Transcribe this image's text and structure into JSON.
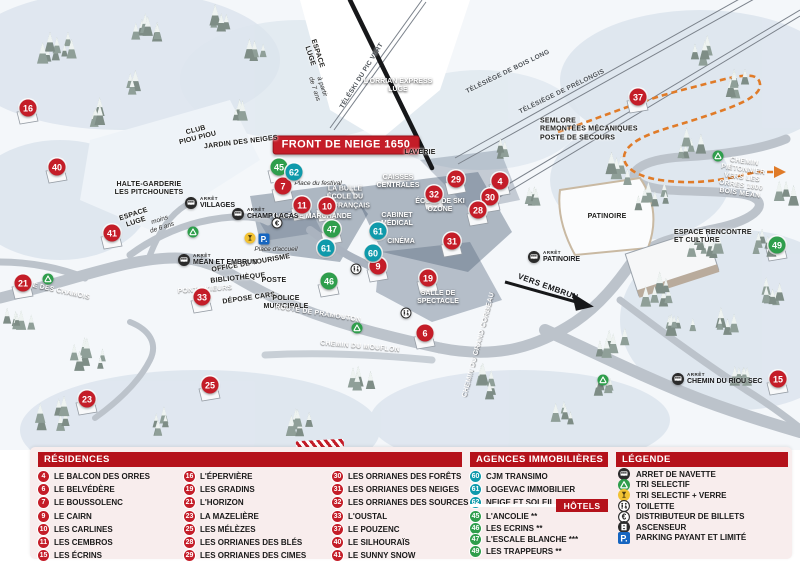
{
  "colors": {
    "residence": "#c41d28",
    "hotel": "#2f9e4c",
    "agency": "#0f9aab",
    "header_bar": "#b5121b",
    "panel_bg": "#f8eded",
    "path_orange": "#e07b28"
  },
  "map": {
    "banner": "FRONT DE NEIGE 1650",
    "bus_stop_prefix": "ARRÊT",
    "markers": [
      {
        "num": "16",
        "type": "residence",
        "x": 28,
        "y": 108
      },
      {
        "num": "40",
        "type": "residence",
        "x": 57,
        "y": 167
      },
      {
        "num": "41",
        "type": "residence",
        "x": 112,
        "y": 233
      },
      {
        "num": "21",
        "type": "residence",
        "x": 23,
        "y": 283
      },
      {
        "num": "23",
        "type": "residence",
        "x": 87,
        "y": 399
      },
      {
        "num": "25",
        "type": "residence",
        "x": 210,
        "y": 385
      },
      {
        "num": "33",
        "type": "residence",
        "x": 202,
        "y": 297
      },
      {
        "num": "7",
        "type": "residence",
        "x": 283,
        "y": 186
      },
      {
        "num": "11",
        "type": "residence",
        "x": 302,
        "y": 205
      },
      {
        "num": "10",
        "type": "residence",
        "x": 327,
        "y": 206
      },
      {
        "num": "9",
        "type": "residence",
        "x": 378,
        "y": 266
      },
      {
        "num": "19",
        "type": "residence",
        "x": 428,
        "y": 278
      },
      {
        "num": "31",
        "type": "residence",
        "x": 452,
        "y": 241
      },
      {
        "num": "6",
        "type": "residence",
        "x": 425,
        "y": 333
      },
      {
        "num": "29",
        "type": "residence",
        "x": 456,
        "y": 179
      },
      {
        "num": "4",
        "type": "residence",
        "x": 500,
        "y": 181
      },
      {
        "num": "32",
        "type": "residence",
        "x": 434,
        "y": 194
      },
      {
        "num": "30",
        "type": "residence",
        "x": 490,
        "y": 197
      },
      {
        "num": "28",
        "type": "residence",
        "x": 478,
        "y": 210
      },
      {
        "num": "37",
        "type": "residence",
        "x": 638,
        "y": 97
      },
      {
        "num": "15",
        "type": "residence",
        "x": 778,
        "y": 379
      },
      {
        "num": "45",
        "type": "hotel",
        "x": 279,
        "y": 167
      },
      {
        "num": "47",
        "type": "hotel",
        "x": 332,
        "y": 229
      },
      {
        "num": "46",
        "type": "hotel",
        "x": 329,
        "y": 281
      },
      {
        "num": "49",
        "type": "hotel",
        "x": 777,
        "y": 245
      },
      {
        "num": "62",
        "type": "agency",
        "x": 294,
        "y": 172
      },
      {
        "num": "61",
        "type": "agency",
        "x": 326,
        "y": 248
      },
      {
        "num": "61",
        "type": "agency",
        "x": 378,
        "y": 231
      },
      {
        "num": "60",
        "type": "agency",
        "x": 373,
        "y": 253
      }
    ],
    "labels": [
      {
        "text": "FRONT DE NEIGE 1650",
        "x": 346,
        "y": 145,
        "cls": "banner"
      },
      {
        "text": "LAVERIE",
        "x": 420,
        "y": 153,
        "cls": "place"
      },
      {
        "text": "CAISSES\nCENTRALES",
        "x": 398,
        "y": 182,
        "cls": "placeW"
      },
      {
        "text": "LA BULLE\nÉCOLE DU\nSKI FRANÇAIS",
        "x": 345,
        "y": 198,
        "cls": "placeW"
      },
      {
        "text": "Place du festival",
        "x": 318,
        "y": 184,
        "cls": "it"
      },
      {
        "text": "GALERIE MARCHANDE",
        "x": 312,
        "y": 217,
        "cls": "placeW"
      },
      {
        "text": "CABINET\nMÉDICAL",
        "x": 397,
        "y": 220,
        "cls": "placeW"
      },
      {
        "text": "CINÉMA",
        "x": 401,
        "y": 242,
        "cls": "placeW"
      },
      {
        "text": "ÉCOLE DE SKI\nOZONE",
        "x": 440,
        "y": 206,
        "cls": "placeW"
      },
      {
        "text": "SALLE DE\nSPECTACLE",
        "x": 438,
        "y": 298,
        "cls": "placeW"
      },
      {
        "text": "OFFICE DE TOURISME",
        "x": 251,
        "y": 264,
        "cls": "place",
        "rot": -10
      },
      {
        "text": "BIBLIOTHÈQUE",
        "x": 238,
        "y": 279,
        "cls": "place",
        "rot": -6
      },
      {
        "text": "POSTE",
        "x": 274,
        "y": 281,
        "cls": "place"
      },
      {
        "text": "DÉPOSE CARS",
        "x": 249,
        "y": 299,
        "cls": "place",
        "rot": -8
      },
      {
        "text": "POLICE\nMUNICIPALE",
        "x": 286,
        "y": 303,
        "cls": "place"
      },
      {
        "text": "HALTE-GARDERIE\nLES PITCHOUNETS",
        "x": 149,
        "y": 189,
        "cls": "place"
      },
      {
        "text": "ESPACE\nLUGE",
        "x": 135,
        "y": 219,
        "cls": "place",
        "rot": -18
      },
      {
        "text": "moins\nde 6 ans",
        "x": 161,
        "y": 224,
        "cls": "it",
        "rot": -18
      },
      {
        "text": "CLUB\nPIOU PIOU",
        "x": 197,
        "y": 135,
        "cls": "place",
        "rot": -14
      },
      {
        "text": "JARDIN DES NEIGES",
        "x": 241,
        "y": 143,
        "cls": "place",
        "rot": -7
      },
      {
        "text": "ESPACE\nLUGE",
        "x": 313,
        "y": 55,
        "cls": "place",
        "rot": 72
      },
      {
        "text": "à partir\nde 7 ans",
        "x": 318,
        "y": 88,
        "cls": "it",
        "rot": 72
      },
      {
        "text": "L'ORRIAN EXPRESS\nLUGE",
        "x": 398,
        "y": 86,
        "cls": "placeW"
      },
      {
        "text": "TÉLÉSKI DU PIC VERT",
        "x": 362,
        "y": 76,
        "cls": "lift",
        "rot": -58
      },
      {
        "text": "TÉLÉSIÈGE DE BOIS LONG",
        "x": 508,
        "y": 72,
        "cls": "lift",
        "rot": -26
      },
      {
        "text": "TÉLÉSIÈGE DE PRÉLONGIS",
        "x": 562,
        "y": 92,
        "cls": "lift",
        "rot": -26
      },
      {
        "text": "SEMLORE\nREMONTÉES MÉCANIQUES\nPOSTE DE SECOURS",
        "x": 540,
        "y": 130,
        "cls": "place left"
      },
      {
        "text": "CHEMIN PIÉTONNIER\nVERS LES ORRES 1800\nBOIS MÉAN",
        "x": 742,
        "y": 178,
        "cls": "road",
        "rot": 8
      },
      {
        "text": "PATINOIRE",
        "x": 607,
        "y": 217,
        "cls": "place"
      },
      {
        "text": "ESPACE RENCONTRE\nET CULTURE",
        "x": 674,
        "y": 237,
        "cls": "place left"
      },
      {
        "text": "VERS EMBRUN",
        "x": 548,
        "y": 287,
        "cls": "roadB",
        "rot": 20
      },
      {
        "text": "ALLÉE DES CHAMOIS",
        "x": 52,
        "y": 290,
        "cls": "road",
        "rot": 12
      },
      {
        "text": "PONT SKIEURS",
        "x": 205,
        "y": 290,
        "cls": "road",
        "rot": -4
      },
      {
        "text": "ROUTE DE PRAMOUTON",
        "x": 318,
        "y": 314,
        "cls": "road",
        "rot": 9
      },
      {
        "text": "CHEMIN DU MOUFLON",
        "x": 360,
        "y": 347,
        "cls": "road",
        "rot": 5
      },
      {
        "text": "CHEMIN DU GRAND CORBEAU",
        "x": 479,
        "y": 345,
        "cls": "road",
        "rot": -75
      },
      {
        "text": "Place d'accueil",
        "x": 276,
        "y": 250,
        "cls": "it"
      }
    ],
    "bus_stops": [
      {
        "name": "VILLAGES",
        "x": 185,
        "y": 203
      },
      {
        "name": "CHAMP LACAS",
        "x": 232,
        "y": 214
      },
      {
        "name": "MÉAN ET EMBRUN",
        "x": 178,
        "y": 260
      },
      {
        "name": "PATINOIRE",
        "x": 528,
        "y": 257
      },
      {
        "name": "CHEMIN DU RIOU SEC",
        "x": 672,
        "y": 379
      }
    ],
    "icons": [
      {
        "type": "recycle",
        "x": 48,
        "y": 279
      },
      {
        "type": "recycle",
        "x": 193,
        "y": 232
      },
      {
        "type": "recycle",
        "x": 357,
        "y": 328
      },
      {
        "type": "recycle",
        "x": 718,
        "y": 156
      },
      {
        "type": "recycle",
        "x": 603,
        "y": 380
      },
      {
        "type": "glass",
        "x": 250,
        "y": 238
      },
      {
        "type": "parking",
        "x": 264,
        "y": 239
      },
      {
        "type": "euro",
        "x": 277,
        "y": 223
      },
      {
        "type": "wc",
        "x": 356,
        "y": 269
      },
      {
        "type": "wc",
        "x": 406,
        "y": 313
      }
    ]
  },
  "legend": {
    "residences": {
      "title": "RÉSIDENCES",
      "items": [
        {
          "num": "4",
          "label": "LE BALCON DES ORRES"
        },
        {
          "num": "6",
          "label": "LE BELVÉDÈRE"
        },
        {
          "num": "7",
          "label": "LE BOUSSOLENC"
        },
        {
          "num": "9",
          "label": "LE CAIRN"
        },
        {
          "num": "10",
          "label": "LES CARLINES"
        },
        {
          "num": "11",
          "label": "LES CEMBROS"
        },
        {
          "num": "15",
          "label": "LES ÉCRINS"
        },
        {
          "num": "16",
          "label": "L'ÉPERVIÈRE"
        },
        {
          "num": "19",
          "label": "LES GRADINS"
        },
        {
          "num": "21",
          "label": "L'HORIZON"
        },
        {
          "num": "23",
          "label": "LA MAZELIÈRE"
        },
        {
          "num": "25",
          "label": "LES MÉLÈZES"
        },
        {
          "num": "28",
          "label": "LES ORRIANES DES BLÉS"
        },
        {
          "num": "29",
          "label": "LES ORRIANES DES CIMES"
        },
        {
          "num": "30",
          "label": "LES ORRIANES DES FORÊTS"
        },
        {
          "num": "31",
          "label": "LES ORRIANES DES NEIGES"
        },
        {
          "num": "32",
          "label": "LES ORRIANES DES SOURCES"
        },
        {
          "num": "33",
          "label": "L'OUSTAL"
        },
        {
          "num": "37",
          "label": "LE POUZENC"
        },
        {
          "num": "40",
          "label": "LE SILHOURAÏS"
        },
        {
          "num": "41",
          "label": "LE SUNNY SNOW"
        }
      ]
    },
    "agencies": {
      "title": "AGENCES IMMOBILIÈRES",
      "items": [
        {
          "num": "60",
          "label": "CJM TRANSIMO"
        },
        {
          "num": "61",
          "label": "LOGEVAC IMMOBILIER"
        },
        {
          "num": "62",
          "label": "NEIGE ET SOLEIL"
        }
      ]
    },
    "hotels": {
      "title": "HÔTELS",
      "items": [
        {
          "num": "45",
          "label": "L'ANCOLIE **"
        },
        {
          "num": "46",
          "label": "LES ECRINS **"
        },
        {
          "num": "47",
          "label": "L'ESCALE BLANCHE ***"
        },
        {
          "num": "49",
          "label": "LES TRAPPEURS **"
        }
      ]
    },
    "legende": {
      "title": "LÉGENDE",
      "items": [
        {
          "icon": "bus",
          "label": "ARRET DE NAVETTE"
        },
        {
          "icon": "recycle",
          "label": "TRI SELECTIF"
        },
        {
          "icon": "glass",
          "label": "TRI SELECTIF + VERRE"
        },
        {
          "icon": "wc",
          "label": "TOILETTE"
        },
        {
          "icon": "euro",
          "label": "DISTRIBUTEUR DE BILLETS"
        },
        {
          "icon": "elevator",
          "label": "ASCENSEUR"
        },
        {
          "icon": "parking",
          "label": "PARKING PAYANT ET LIMITÉ"
        }
      ]
    }
  }
}
